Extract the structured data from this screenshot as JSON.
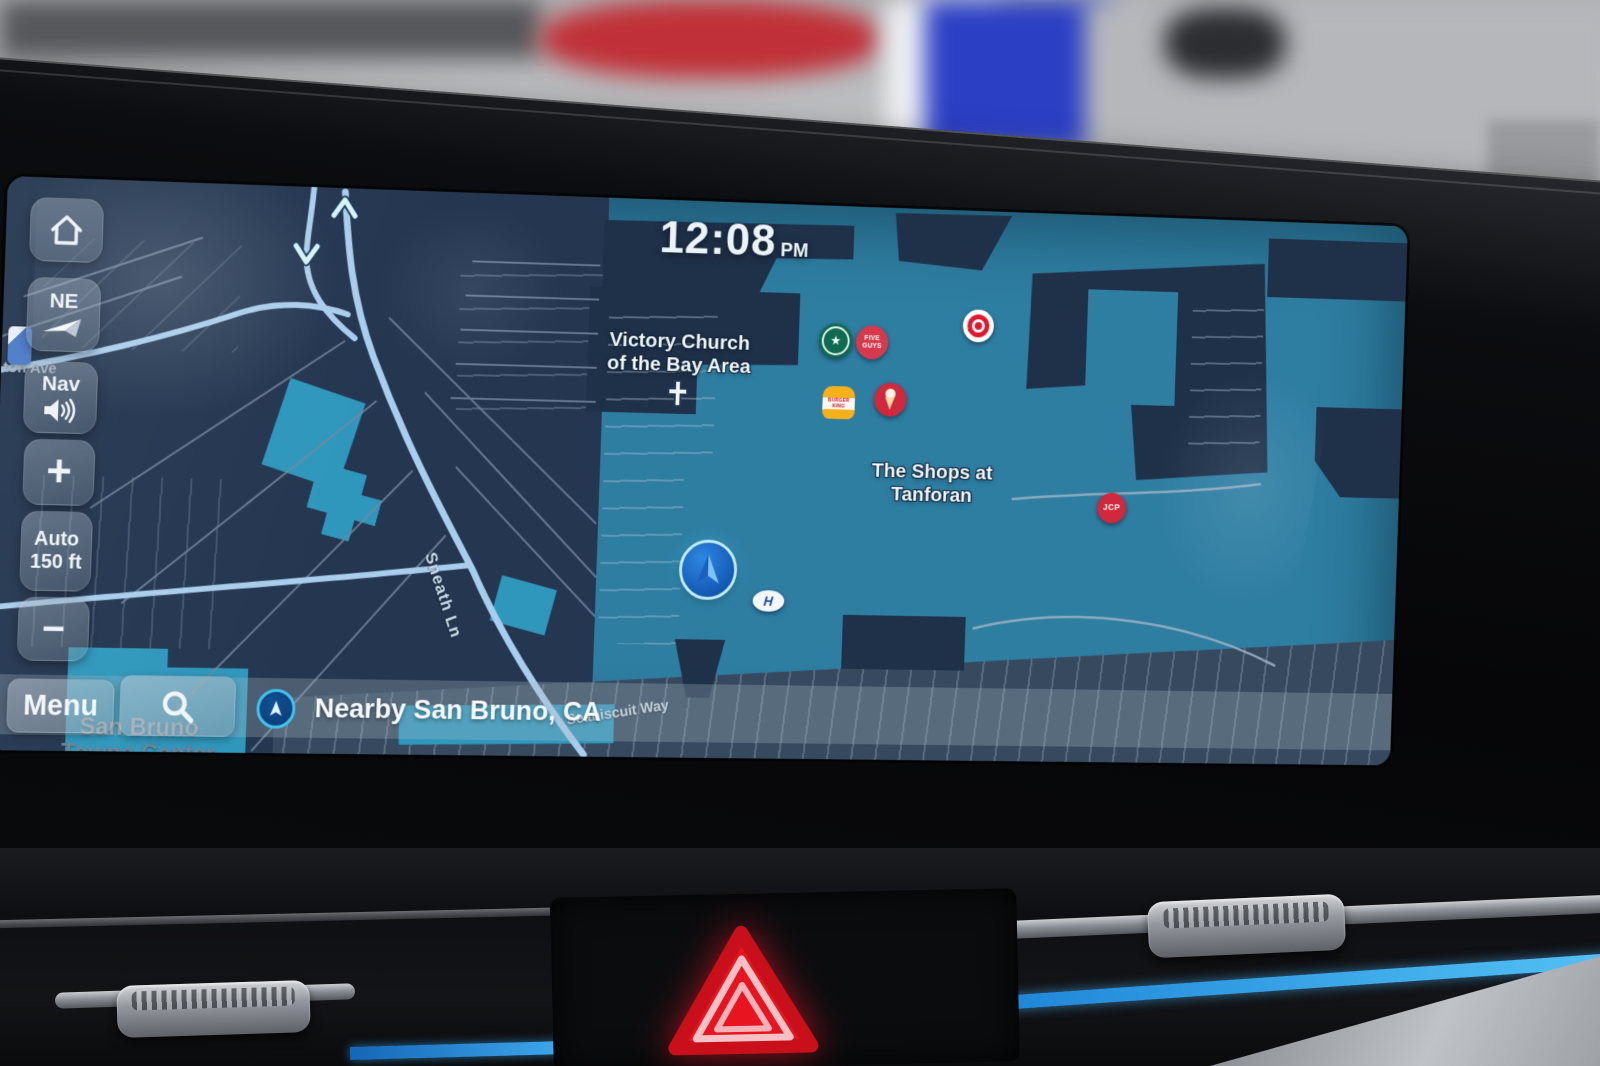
{
  "clock": {
    "time": "12:08",
    "meridiem": "PM"
  },
  "sidebar": {
    "compass_label": "NE",
    "nav_volume_label": "Nav",
    "zoom_in_label": "+",
    "scale_line1": "Auto",
    "scale_line2": "150 ft",
    "zoom_out_label": "−"
  },
  "bottom_bar": {
    "menu_label": "Menu",
    "nearby_label": "Nearby San Bruno, CA"
  },
  "map_labels": {
    "church_line1": "Victory Church",
    "church_line2": "of the Bay Area",
    "mall_line1": "The Shops at",
    "mall_line2": "Tanforan",
    "street_sneath": "Sneath Ln",
    "street_seabiscuit": "Seabiscuit Way",
    "street_partial": "ton Ave",
    "area_line1": "San Bruno",
    "area_line2": "Towne Center"
  },
  "pois": {
    "five_guys_line1": "FIVE",
    "five_guys_line2": "GUYS",
    "burger_king_line1": "BURGER",
    "burger_king_line2": "KING",
    "jcpenney_label": "JCP",
    "hyundai_dealer_label": "H"
  },
  "colors": {
    "map_teal": "#2e7ea2",
    "map_navy": "#243650",
    "building_navy": "#1f3049",
    "road_blue": "#a9cdec",
    "teal_building": "#2f97bc",
    "poi_red": "#d7293c",
    "starbucks_green": "#0e6b50",
    "accent_cyan": "#49c8ec",
    "ambient_blue": "#3fb0ee",
    "hazard_red": "#e8141f"
  }
}
